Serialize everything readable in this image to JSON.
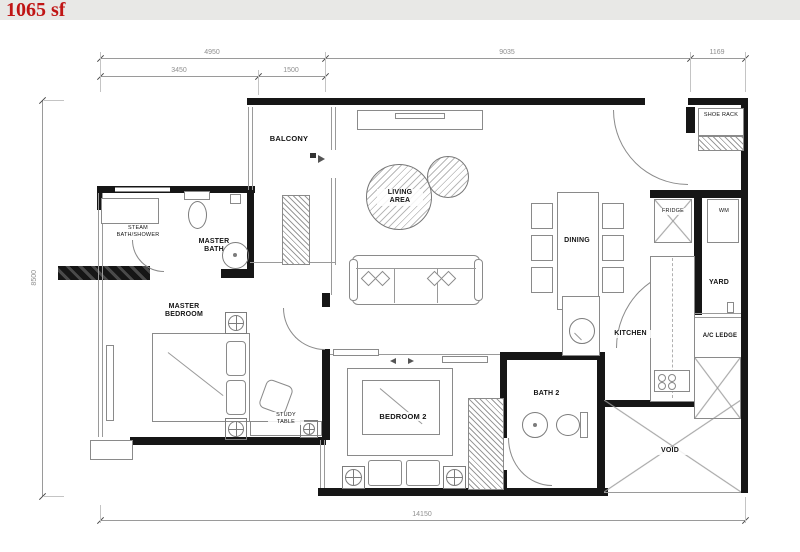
{
  "title": "1065 sf",
  "colors": {
    "accent_red": "#c01515",
    "header_bg": "#e8e8e6",
    "wall": "#161616",
    "thin_line": "#8a8a8a"
  },
  "dimensions": {
    "top_width_1": "4950",
    "top_width_2": "9035",
    "top_width_3": "1169",
    "top_sub_1": "3450",
    "top_sub_2": "1500",
    "left_height": "8500",
    "bottom_width": "14150"
  },
  "rooms": {
    "balcony": "BALCONY",
    "living": "LIVING AREA",
    "dining": "DINING",
    "master_bath": "MASTER BATH",
    "steam": "STEAM BATH/SHOWER",
    "master_bedroom": "MASTER BEDROOM",
    "study": "STUDY TABLE",
    "bedroom2": "BEDROOM 2",
    "bath2": "BATH 2",
    "kitchen": "KITCHEN",
    "yard": "YARD",
    "ac_ledge": "A/C LEDGE",
    "void": "VOID",
    "shoe_rack": "SHOE RACK",
    "fridge": "FRIDGE",
    "wm": "WM"
  }
}
